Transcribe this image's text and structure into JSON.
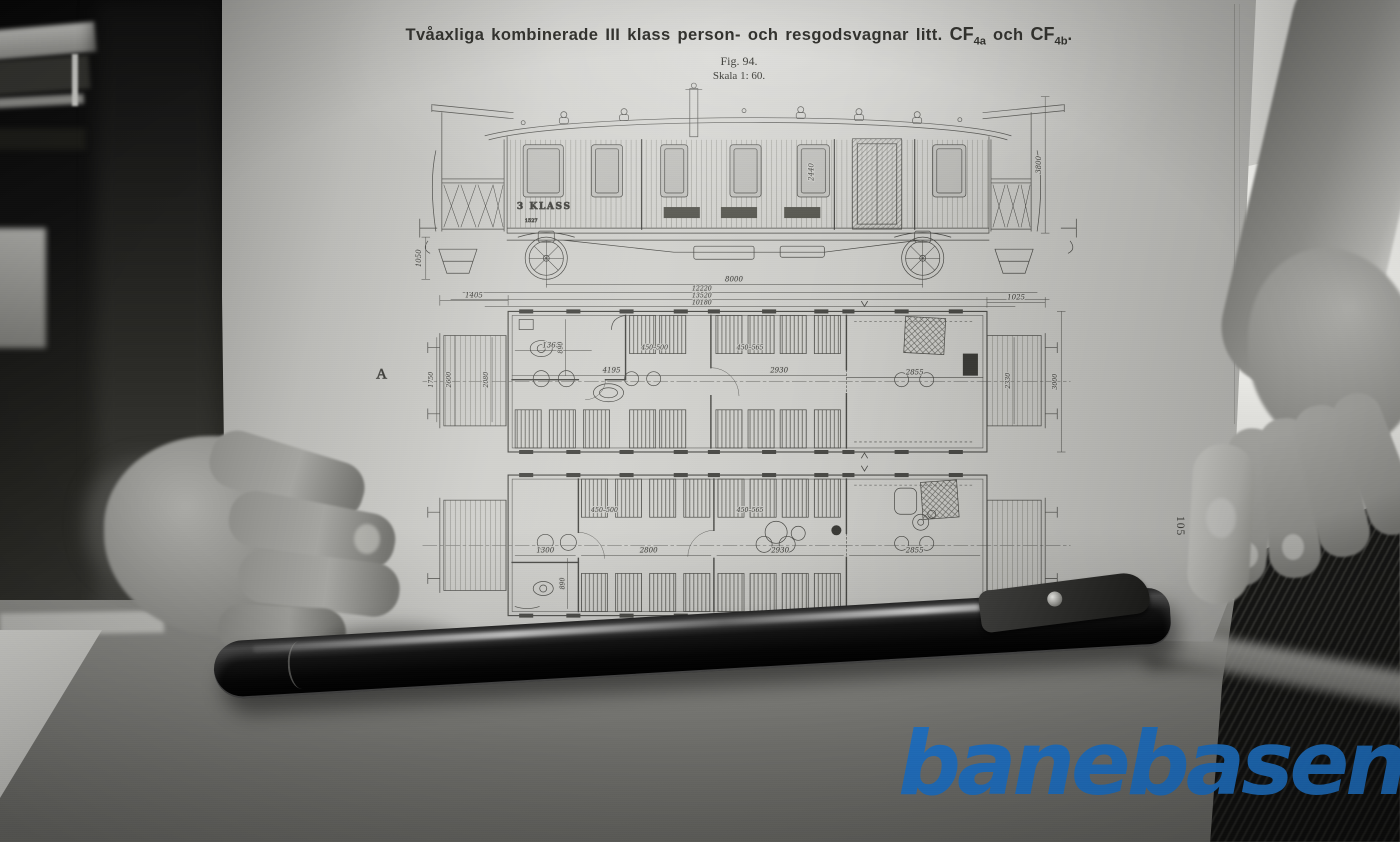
{
  "page": {
    "title": {
      "main": "Tvåaxliga kombinerade III klass person- och resgodsvagnar litt.",
      "cf1": "CF",
      "cf1_sub": "4a",
      "conj": "och",
      "cf2": "CF",
      "cf2_sub": "4b",
      "end": "."
    },
    "figure": "Fig. 94.",
    "scale": "Skala 1: 60.",
    "page_number": "105"
  },
  "drawing": {
    "car_class_text": "3 KLASS",
    "car_number": "1527",
    "view_a_label": "A",
    "view_b_label": "B",
    "side_dims": {
      "d1050": "1050",
      "d2440": "2440",
      "d3800": "3800",
      "d8000": "8000",
      "d12220": "12220",
      "d13520": "13520",
      "d10180": "10180"
    },
    "plan_a_dims": {
      "d1405": "1405",
      "d1025": "1025",
      "d1750": "1750",
      "d2600": "2600",
      "d2080": "2080",
      "d1365": "1365",
      "d890": "890",
      "d450_500": "450–500",
      "d450_565": "450–565",
      "d4195": "4195",
      "d2930": "2930",
      "d2855": "2855",
      "d2330": "2330",
      "d3000": "3000"
    },
    "plan_b_dims": {
      "d450_500": "450–500",
      "d450_565": "450–565",
      "d1300": "1300",
      "d890": "890",
      "d2800": "2800",
      "d2930": "2930",
      "d2855": "2855"
    }
  },
  "watermark": {
    "text": "banebasen",
    "color": "#1e70c2"
  }
}
